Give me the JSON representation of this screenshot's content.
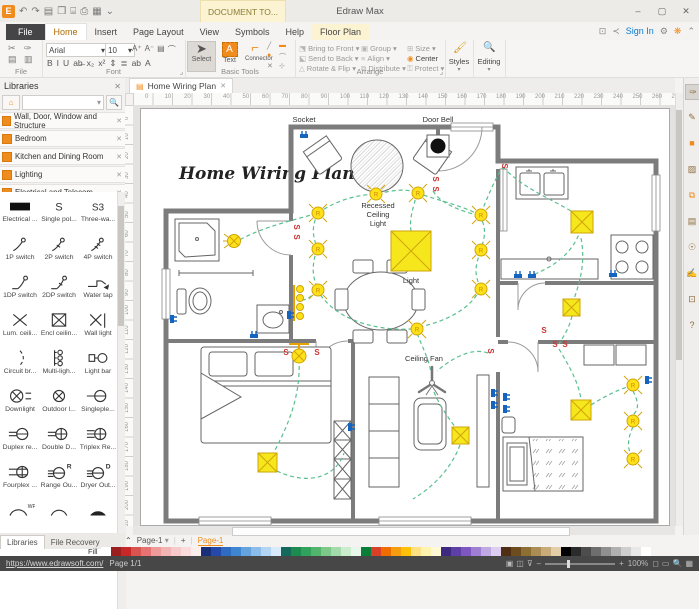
{
  "titlebar": {
    "app_title": "Edraw Max",
    "context_tab": "DOCUMENT TO...",
    "qat_icons": [
      {
        "name": "app-logo",
        "char": "E"
      },
      {
        "name": "undo-icon",
        "char": "↶"
      },
      {
        "name": "redo-icon",
        "char": "↷"
      },
      {
        "name": "new-file-icon",
        "char": "▤"
      },
      {
        "name": "open-icon",
        "char": "❒"
      },
      {
        "name": "save-icon",
        "char": "⌸"
      },
      {
        "name": "print-icon",
        "char": "⎙"
      },
      {
        "name": "export-icon",
        "char": "▦"
      },
      {
        "name": "customize-quick-access-icon",
        "char": "⌄"
      }
    ],
    "window_controls": {
      "minimize": "–",
      "maximize": "▢",
      "close": "✕"
    }
  },
  "menubar": {
    "tabs": [
      "File",
      "Home",
      "Insert",
      "Page Layout",
      "View",
      "Symbols",
      "Help",
      "Floor Plan"
    ],
    "active_tab": "Home",
    "context_tab": "Floor Plan",
    "right_icons": [
      {
        "name": "snapshot-icon",
        "char": "⊡"
      },
      {
        "name": "share-icon",
        "char": "≺"
      }
    ],
    "sign_in": "Sign In",
    "gear_icon": "⚙",
    "theme_icon": "❋",
    "collapse_ribbon_icon": "⌃"
  },
  "ribbon": {
    "file_group": {
      "label": "File",
      "icons": [
        {
          "name": "cut-icon",
          "char": "✂"
        },
        {
          "name": "format-brush-icon",
          "char": "✑"
        },
        {
          "name": "copy-icon",
          "char": "▤"
        },
        {
          "name": "paste-icon",
          "char": "▥"
        }
      ]
    },
    "font_group": {
      "label": "Font",
      "font_name": "Arial",
      "font_size": "10",
      "dropdown": "▾",
      "row1_icons": [
        {
          "name": "grow-font-icon",
          "char": "A⁺"
        },
        {
          "name": "shrink-font-icon",
          "char": "A⁻"
        },
        {
          "name": "text-style-icon",
          "char": "▤"
        },
        {
          "name": "arc-text-icon",
          "char": "⌒"
        }
      ],
      "row2_icons": [
        {
          "name": "bold-icon",
          "char": "B"
        },
        {
          "name": "italic-icon",
          "char": "I"
        },
        {
          "name": "underline-icon",
          "char": "U"
        },
        {
          "name": "strike-icon",
          "char": "ab̶"
        },
        {
          "name": "subscript-icon",
          "char": "x₂"
        },
        {
          "name": "superscript-icon",
          "char": "x²"
        },
        {
          "name": "line-spacing-icon",
          "char": "⇕"
        },
        {
          "name": "align-icon",
          "char": "≣"
        },
        {
          "name": "highlight-icon",
          "char": "ab"
        },
        {
          "name": "font-color-icon",
          "char": "A"
        }
      ],
      "expander": "⌟"
    },
    "basic_tools_group": {
      "label": "Basic Tools",
      "select_label": "Select",
      "text_label": "Text",
      "connector_label": "Connector",
      "select_icon": "➤",
      "connector_icon": "⌐",
      "dropdown": "▾",
      "draw_icons": [
        {
          "name": "line-tool-icon",
          "char": "╱",
          "color": "#888"
        },
        {
          "name": "rect-tool-icon",
          "char": "▬",
          "color": "#f08c1e"
        },
        {
          "name": "ellipse-tool-icon",
          "char": "●",
          "color": "#f08c1e"
        },
        {
          "name": "curve-tool-icon",
          "char": "⌒",
          "color": "#888"
        },
        {
          "name": "erase-tool-icon",
          "char": "✕",
          "color": "#888"
        },
        {
          "name": "crop-tool-icon",
          "char": "⊹",
          "color": "#888"
        }
      ]
    },
    "arrange_group": {
      "label": "Arrange",
      "expander": "⌟",
      "columns": [
        [
          {
            "icon": "⬔",
            "label": "Bring to Front ▾"
          },
          {
            "icon": "⬕",
            "label": "Send to Back ▾"
          },
          {
            "icon": "△",
            "label": "Rotate & Flip ▾"
          }
        ],
        [
          {
            "icon": "▣",
            "label": "Group ▾"
          },
          {
            "icon": "≡",
            "label": "Align ▾"
          },
          {
            "icon": "⧉",
            "label": "Distribute ▾"
          }
        ],
        [
          {
            "icon": "⊞",
            "label": "Size ▾"
          },
          {
            "icon": "◉",
            "label": "Center"
          },
          {
            "icon": "⚿",
            "label": "Protect ▾"
          }
        ]
      ]
    },
    "styles_group": {
      "label": "Styles",
      "icon": "🖌",
      "dropdown": "▾"
    },
    "editing_group": {
      "label": "Editing",
      "icon": "🔍",
      "dropdown": "▾"
    }
  },
  "libraries": {
    "title": "Libraries",
    "close_icon": "✕",
    "search_placeholder": "",
    "search_dropdown": "▾",
    "search_icon": "🔍",
    "home_icon": "⌂",
    "categories": [
      "Wall, Door, Window and Structure",
      "Bedroom",
      "Kitchen and Dining Room",
      "Lighting",
      "Electrical and Telecom"
    ],
    "symbols": [
      {
        "label": "Electrical ...",
        "glyph": "elec"
      },
      {
        "label": "Single pol...",
        "glyph": "s1"
      },
      {
        "label": "Three-wa...",
        "glyph": "s3"
      },
      {
        "label": "1P switch",
        "glyph": "sw1"
      },
      {
        "label": "2P switch",
        "glyph": "sw2"
      },
      {
        "label": "4P switch",
        "glyph": "sw4"
      },
      {
        "label": "1DP switch",
        "glyph": "dp1"
      },
      {
        "label": "2DP switch",
        "glyph": "dp2"
      },
      {
        "label": "Water tap",
        "glyph": "tap"
      },
      {
        "label": "Lum. ceili...",
        "glyph": "lum"
      },
      {
        "label": "Encl ceilin...",
        "glyph": "encl"
      },
      {
        "label": "Wall light",
        "glyph": "wall"
      },
      {
        "label": "Circuit br...",
        "glyph": "circ"
      },
      {
        "label": "Multi-ligh...",
        "glyph": "multi"
      },
      {
        "label": "Light bar",
        "glyph": "lbar"
      },
      {
        "label": "Downlight",
        "glyph": "down"
      },
      {
        "label": "Outdoor l...",
        "glyph": "outd"
      },
      {
        "label": "Singleple...",
        "glyph": "single"
      },
      {
        "label": "Duplex re...",
        "glyph": "dupl"
      },
      {
        "label": "Double D...",
        "glyph": "dbl"
      },
      {
        "label": "Triplex Re...",
        "glyph": "tri"
      },
      {
        "label": "Fourplex ...",
        "glyph": "four"
      },
      {
        "label": "Range Ou...",
        "glyph": "range"
      },
      {
        "label": "Dryer Out...",
        "glyph": "dryer"
      }
    ],
    "symbols_partial": [
      {
        "glyph": "arcwp"
      },
      {
        "glyph": "arc"
      },
      {
        "glyph": "arcf"
      }
    ],
    "bottom_tabs": [
      "Libraries",
      "File Recovery"
    ],
    "active_bottom_tab": "Libraries"
  },
  "canvas": {
    "doc_tab": "Home Wiring Plan",
    "doc_tab_close": "✕",
    "h_ruler_ticks": [
      0,
      10,
      20,
      30,
      40,
      50,
      60,
      70,
      80,
      90,
      100,
      110,
      120,
      130,
      140,
      150,
      160,
      170,
      180,
      190,
      200,
      210,
      220,
      230,
      240,
      250,
      260,
      270
    ],
    "v_ruler_ticks": [
      0,
      10,
      20,
      30,
      40,
      50,
      60,
      70,
      80,
      90,
      100,
      110,
      120,
      130,
      140,
      150,
      160,
      170,
      180,
      190,
      200,
      210
    ]
  },
  "plan": {
    "title": "Home Wiring Plan",
    "labels": {
      "socket": "Socket",
      "door_bell": "Door Bell",
      "recessed_lines": [
        "Recessed",
        "Ceiling",
        "Light"
      ],
      "light": "Light",
      "ceiling_fan": "Ceiling Fan"
    },
    "colors": {
      "wall": "#7c7c7c",
      "wire": "#5abf8f",
      "light_fill": "#ffe11a",
      "light_stroke": "#cfa50a",
      "switch": "#cc3333",
      "socket": "#1565c0"
    }
  },
  "rightbar": {
    "icons": [
      {
        "name": "format-painter-icon",
        "char": "✑",
        "active": true
      },
      {
        "name": "pen-tool-icon",
        "char": "✎",
        "active": false
      },
      {
        "name": "fill-color-icon",
        "char": "■",
        "active": false,
        "color": "#f08c1e"
      },
      {
        "name": "picture-icon",
        "char": "▨",
        "active": false
      },
      {
        "name": "shape-library-icon",
        "char": "⧉",
        "active": false,
        "color": "#f08c1e"
      },
      {
        "name": "note-icon",
        "char": "▤",
        "active": false
      },
      {
        "name": "web-icon",
        "char": "☉",
        "active": false
      },
      {
        "name": "edit-doc-icon",
        "char": "✍",
        "active": false
      },
      {
        "name": "comment-icon",
        "char": "⊡",
        "active": false
      },
      {
        "name": "help-icon",
        "char": "?",
        "active": false
      }
    ]
  },
  "bottom": {
    "collapse_icon": "⌃",
    "page_selector": "Page-1",
    "page_selector_dropdown": "▾",
    "add_page": "+",
    "page_tab": "Page-1",
    "fill_label": "Fill",
    "palette": [
      "#ffffff",
      "#9c1f1f",
      "#c62828",
      "#d9534f",
      "#e57373",
      "#ef9a9a",
      "#f2b3b3",
      "#f6caca",
      "#fadcdc",
      "#fdeeee",
      "#1a2f7a",
      "#2449a8",
      "#2d6cc0",
      "#3f86d2",
      "#64a3de",
      "#8cbce9",
      "#b3d4f2",
      "#d9eafa",
      "#136a5a",
      "#1d8a50",
      "#2fa35c",
      "#52b56e",
      "#7cc98a",
      "#a4dbab",
      "#cbeccd",
      "#e8f7e9",
      "#0a7d3b",
      "#d9402a",
      "#ef6c00",
      "#f59d0e",
      "#ffc107",
      "#ffe082",
      "#fff3b0",
      "#fff9d6",
      "#3d2a80",
      "#5e3fa6",
      "#7e57c2",
      "#9f7fd4",
      "#c0a8e2",
      "#ddcdf0",
      "#4e2f14",
      "#6d4c1f",
      "#8d6e33",
      "#ab8c54",
      "#c9ab79",
      "#e2cfa8",
      "#000000",
      "#2b2b2b",
      "#4d4d4d",
      "#6e6e6e",
      "#8f8f8f",
      "#b0b0b0",
      "#cfcfcf",
      "#e8e8e8",
      "#ffffff"
    ]
  },
  "statusbar": {
    "url": "https://www.edrawsoft.com/",
    "page_info": "Page 1/1",
    "zoom_out": "–",
    "zoom_in": "+",
    "zoom_level": "100%",
    "fit_icons": [
      {
        "name": "pan-icon",
        "char": "▣"
      },
      {
        "name": "page-view-icon",
        "char": "◫"
      },
      {
        "name": "layers-icon",
        "char": "⊽"
      }
    ],
    "right_icons": [
      {
        "name": "fit-width-icon",
        "char": "◻"
      },
      {
        "name": "fit-page-icon",
        "char": "▭"
      },
      {
        "name": "magnifier-icon",
        "char": "🔍"
      },
      {
        "name": "grid-icon",
        "char": "▦"
      }
    ]
  }
}
